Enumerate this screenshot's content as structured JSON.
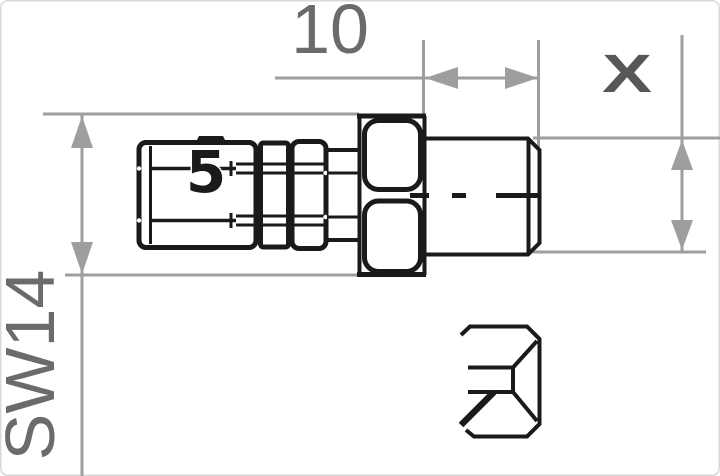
{
  "drawing": {
    "labels": {
      "top_dimension": "10",
      "left_dimension": "SW14",
      "right_dimension": "X",
      "body_marking": "5"
    },
    "colors": {
      "outline": "#1a1a1a",
      "dimension_line": "#9e9e9e",
      "dimension_text": "#6b6b6b",
      "x_mark": "#57575a",
      "border": "#d9d9d9",
      "background": "#ffffff"
    }
  }
}
